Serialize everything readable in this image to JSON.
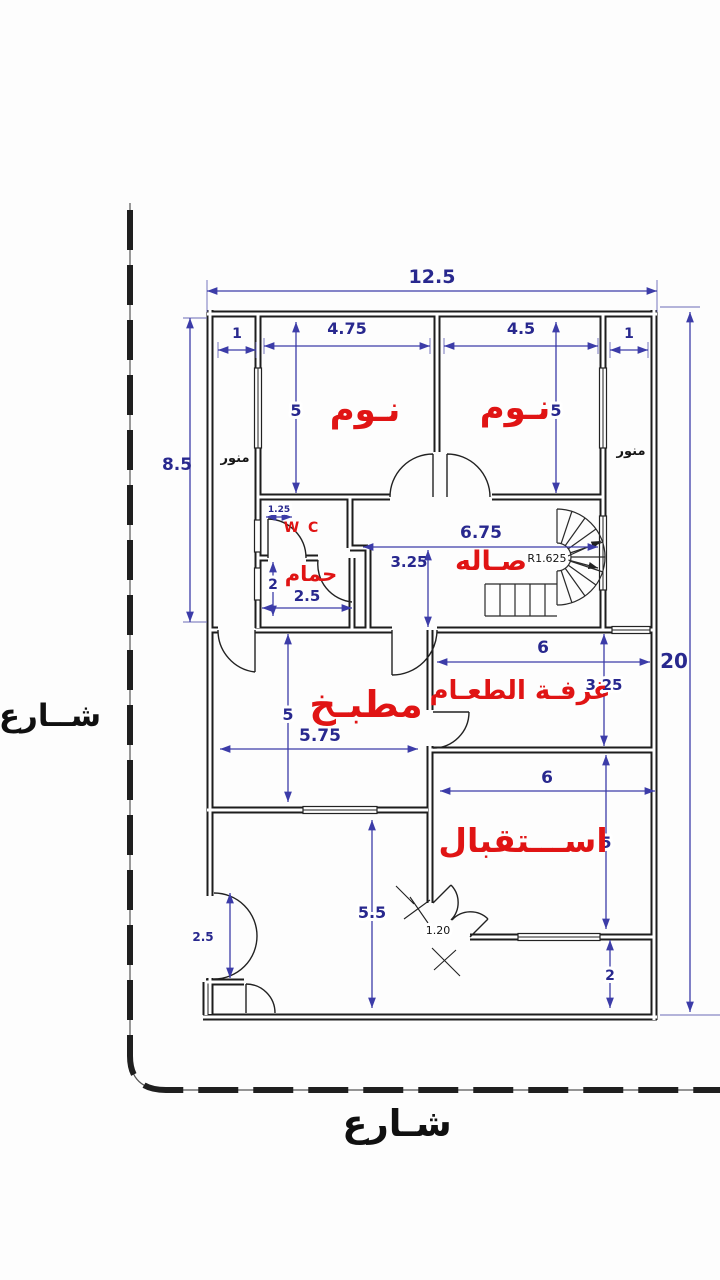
{
  "type": "architectural-floor-plan",
  "language": "Arabic",
  "street_labels": {
    "left": "شــارع",
    "bottom": "شـارع"
  },
  "rooms": {
    "bedroom_left": "نـوم",
    "bedroom_right": "نـوم",
    "wc": "W C",
    "bathroom": "حمام",
    "hall": "صـاله",
    "kitchen": "مطبـخ",
    "dining": "غرفـة الطعـام",
    "reception": "اســـتقبال",
    "lightwell_left": "منور",
    "lightwell_right": "منور"
  },
  "dims": {
    "total_width": "12.5",
    "total_height": "20",
    "upper_left_height": "8.5",
    "lightwell_left_width": "1",
    "bedroom_left_width": "4.75",
    "bedroom_right_width": "4.5",
    "lightwell_right_width": "1",
    "bedroom_left_height": "5",
    "bedroom_right_height": "5",
    "wc_width": "1.25",
    "bathroom_height": "2",
    "bathroom_width": "2.5",
    "hall_width": "6.75",
    "hall_height": "3.25",
    "stair_radius": "R1.625",
    "kitchen_height": "5",
    "kitchen_width": "5.75",
    "dining_width": "6",
    "dining_height": "3.25",
    "reception_width": "6",
    "reception_height": "5",
    "corridor_height": "5.5",
    "entrance_width": "1.20",
    "side_entrance_width": "2.5",
    "bottom_strip_height": "2"
  },
  "colors": {
    "walls": "#1d1d1d",
    "dimensions": "#28288e",
    "room_labels": "#e01414",
    "street_text": "#101010"
  }
}
